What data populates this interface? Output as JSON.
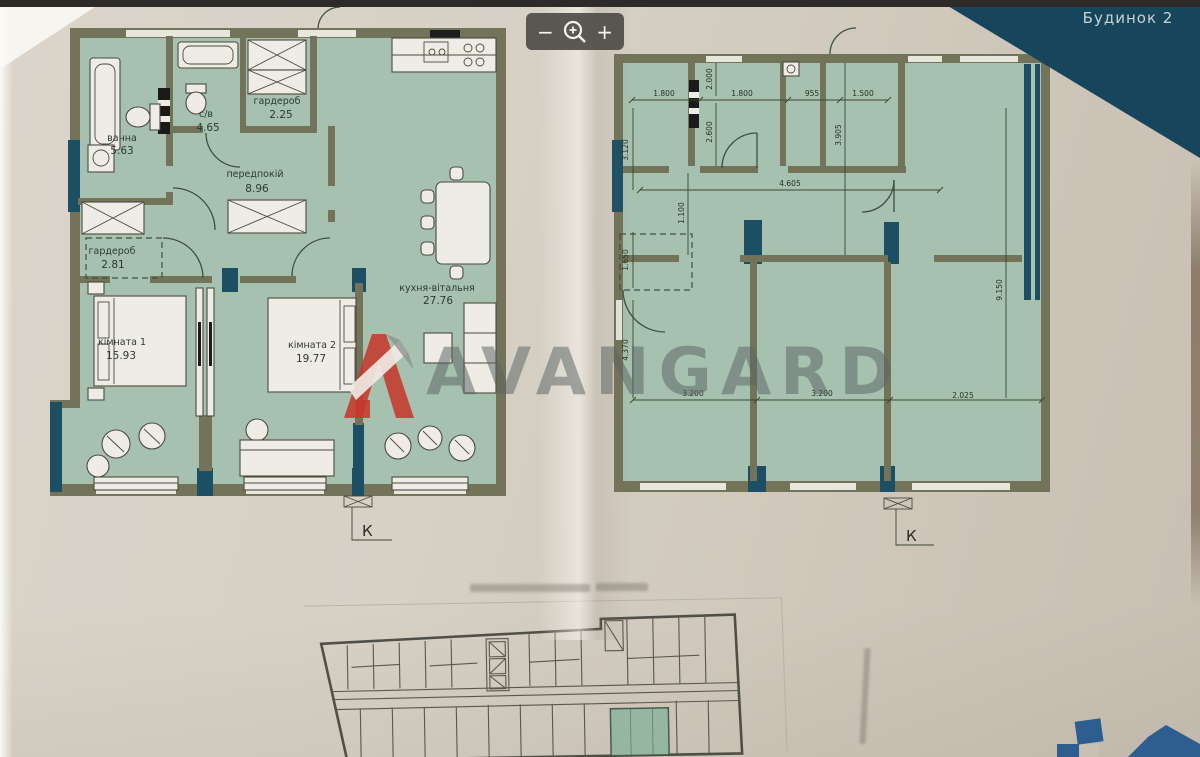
{
  "viewer": {
    "building_label": "Будинок 2",
    "zoom_toolbar": {
      "zoom_out_label": "−",
      "zoom_in_label": "+",
      "magnifier_icon": "magnifier-plus"
    }
  },
  "watermark": {
    "brand": "AVANGARD",
    "logo_color": "#c6392d",
    "text_color": "rgba(90,99,98,0.52)"
  },
  "plan_furnished": {
    "rooms": [
      {
        "name": "ванна",
        "area": "5.63"
      },
      {
        "name": "с/в",
        "area": "4.65"
      },
      {
        "name": "гардероб",
        "area": "2.25"
      },
      {
        "name": "передпокій",
        "area": "8.96"
      },
      {
        "name": "гардероб",
        "area": "2.81"
      },
      {
        "name": "кімната 1",
        "area": "15.93"
      },
      {
        "name": "кімната 2",
        "area": "19.77"
      },
      {
        "name": "кухня-вітальня",
        "area": "27.76"
      }
    ],
    "section_mark": "К"
  },
  "plan_dimensioned": {
    "dims_top": [
      "1.800",
      "1.800",
      "955",
      "1.500"
    ],
    "dims_left": [
      "3.120",
      "1.650",
      "4.370"
    ],
    "dims_inner": [
      "2.000",
      "2.600",
      "4.605",
      "1.100",
      "3.905"
    ],
    "dims_bottom": [
      "3.200",
      "3.200",
      "2.025"
    ],
    "dims_right": [
      "9.150"
    ],
    "section_mark": "К"
  },
  "colors": {
    "paper": "#d5cfc4",
    "plan_fill": "#a6c1af",
    "wall": "#73735a",
    "glazing": "#1c4f63",
    "banner": "#16455c",
    "toolbar": "#514f48",
    "highlight_unit": "#8cb49c",
    "corner_logo_blue": "#2e5d90"
  }
}
